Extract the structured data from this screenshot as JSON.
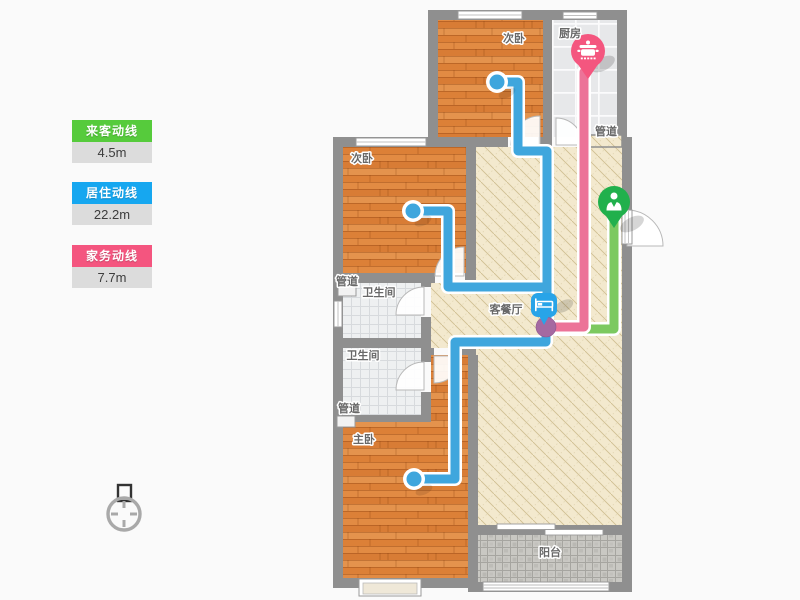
{
  "legend": {
    "items": [
      {
        "label": "来客动线",
        "value": "4.5m",
        "color": "#56cb3c"
      },
      {
        "label": "居住动线",
        "value": "22.2m",
        "color": "#16a7f0"
      },
      {
        "label": "家务动线",
        "value": "7.7m",
        "color": "#f4557f"
      }
    ]
  },
  "floorplan": {
    "labels": {
      "bedroom_top": "次卧",
      "kitchen": "厨房",
      "duct_kitchen": "管道",
      "bedroom_mid": "次卧",
      "duct_upper": "管道",
      "bathroom_1": "卫生间",
      "living": "客餐厅",
      "bathroom_2": "卫生间",
      "duct_lower": "管道",
      "master": "主卧",
      "balcony": "阳台"
    },
    "markers": [
      {
        "name": "kitchen-marker",
        "icon": "cooking-pot-icon",
        "color": "#f4567f"
      },
      {
        "name": "entry-marker",
        "icon": "person-icon",
        "color": "#21b04c"
      },
      {
        "name": "living-marker",
        "icon": "bed-icon",
        "color": "#28a4e8"
      }
    ],
    "routes": [
      {
        "name": "visitor-route",
        "color": "#7cc960"
      },
      {
        "name": "resident-route",
        "color": "#3fa6dd"
      },
      {
        "name": "housework-route",
        "color": "#ec7398"
      }
    ],
    "junction_color": "#a569a1"
  }
}
